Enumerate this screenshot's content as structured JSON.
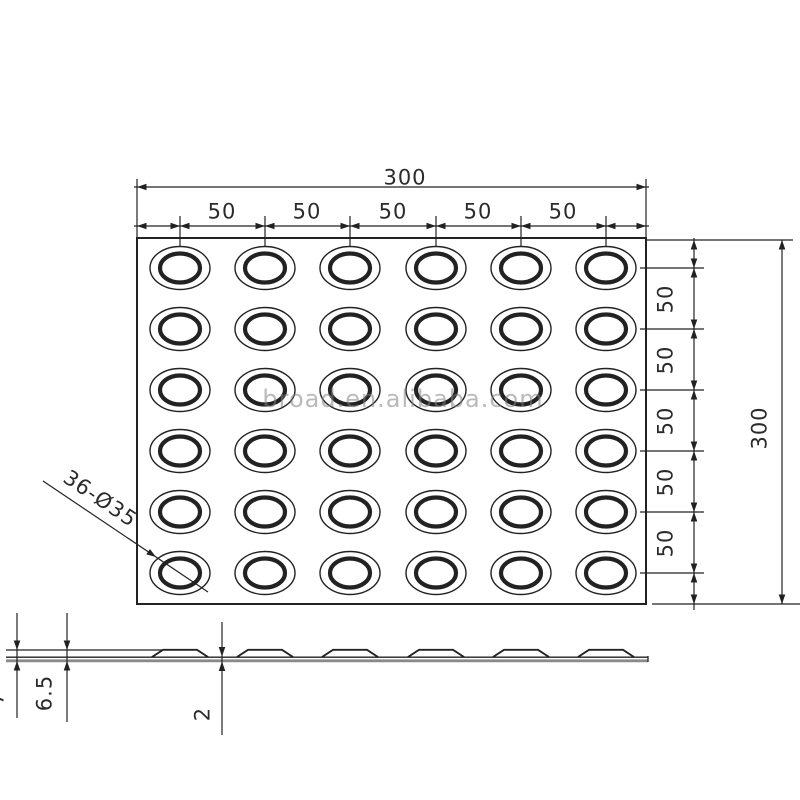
{
  "watermark": {
    "text": "broad.en.alibaba.com"
  },
  "top_view": {
    "width_dim": "300",
    "height_dim": "300",
    "col_dims": [
      "50",
      "50",
      "50",
      "50",
      "50"
    ],
    "row_dims": [
      "50",
      "50",
      "50",
      "50",
      "50"
    ],
    "dot_callout": "36-Ø35",
    "grid": {
      "rows": 6,
      "cols": 6
    }
  },
  "side_view": {
    "overall_height_dim": "6.5",
    "base_thickness_dim": "2",
    "clipped_dim": "7",
    "bump_count": 6
  }
}
